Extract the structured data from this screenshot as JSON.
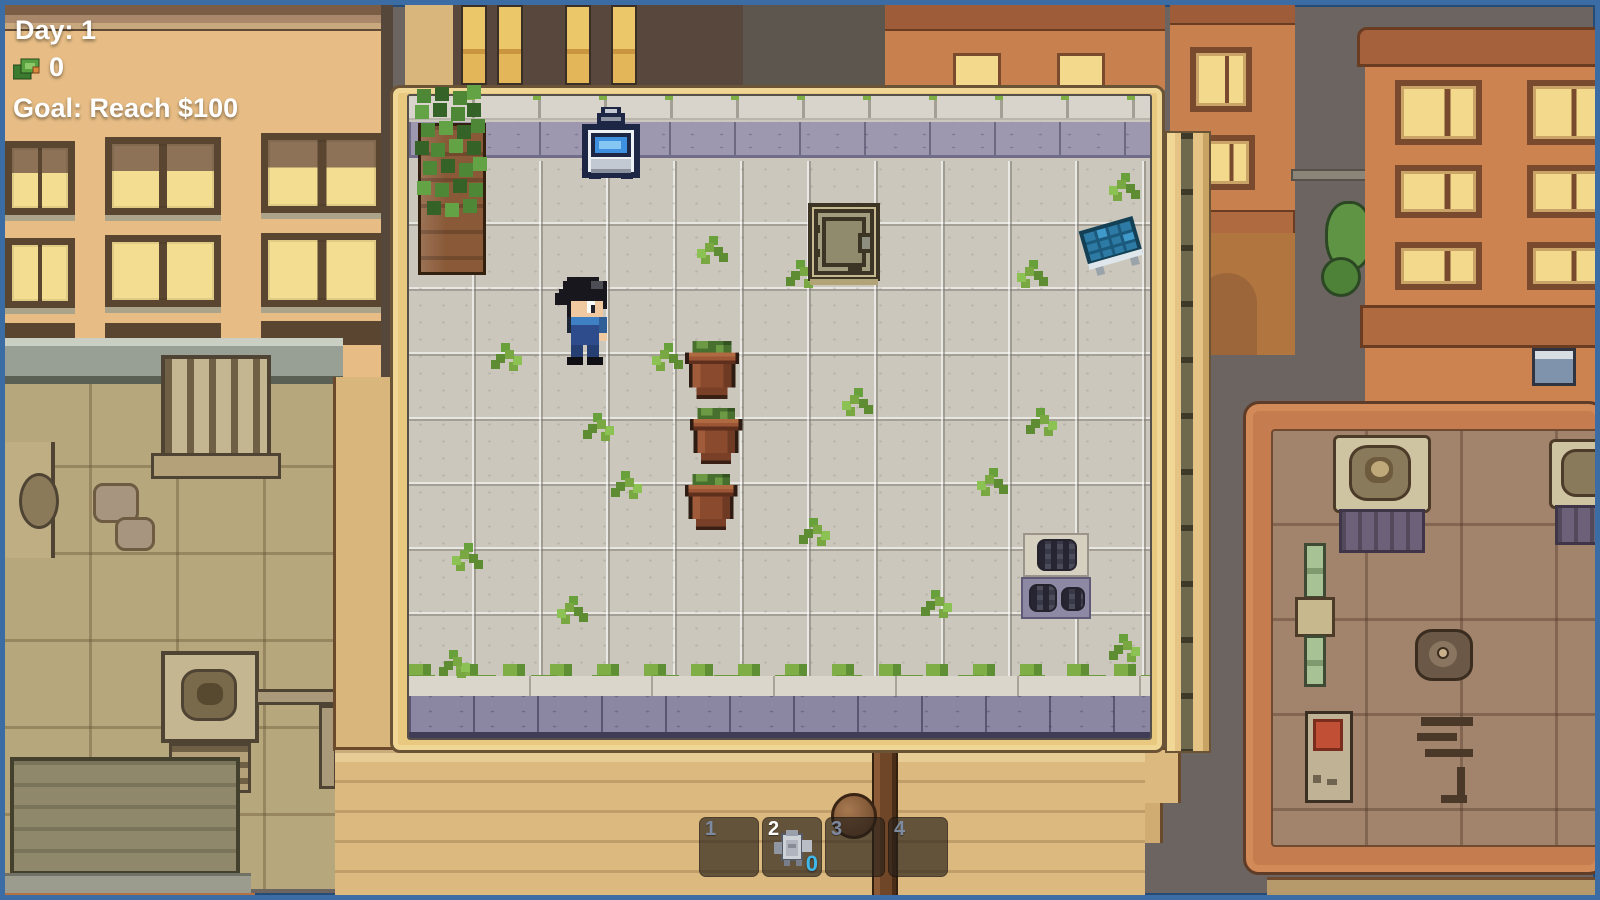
{
  "hud": {
    "day": "Day: 1",
    "money": "0",
    "goal": "Goal: Reach $100"
  },
  "hotbar": {
    "slots": [
      {
        "number": "1",
        "item": "",
        "count": ""
      },
      {
        "number": "2",
        "item": "sprinkler-machine",
        "count": "0",
        "selected": true
      },
      {
        "number": "3",
        "item": "",
        "count": ""
      },
      {
        "number": "4",
        "item": "",
        "count": ""
      }
    ]
  },
  "colors": {
    "hud_text": "#ffffff",
    "slot_number": "#7d8aa0",
    "slot_number_selected": "#ffffff",
    "item_count": "#3fb9ea",
    "screen_border_blue": "#3b6da4",
    "roof_tile": "#cbc7bc",
    "parapet_purple": "#9d98b0",
    "wood_frame": "#e9c87f"
  },
  "scene": {
    "objects": [
      "ivy-planter",
      "sell-terminal",
      "roof-hatch",
      "solar-panel",
      "clay-pot-1",
      "clay-pot-2",
      "clay-pot-3",
      "roof-vent-upper",
      "roof-vent-lower",
      "player-character"
    ]
  }
}
